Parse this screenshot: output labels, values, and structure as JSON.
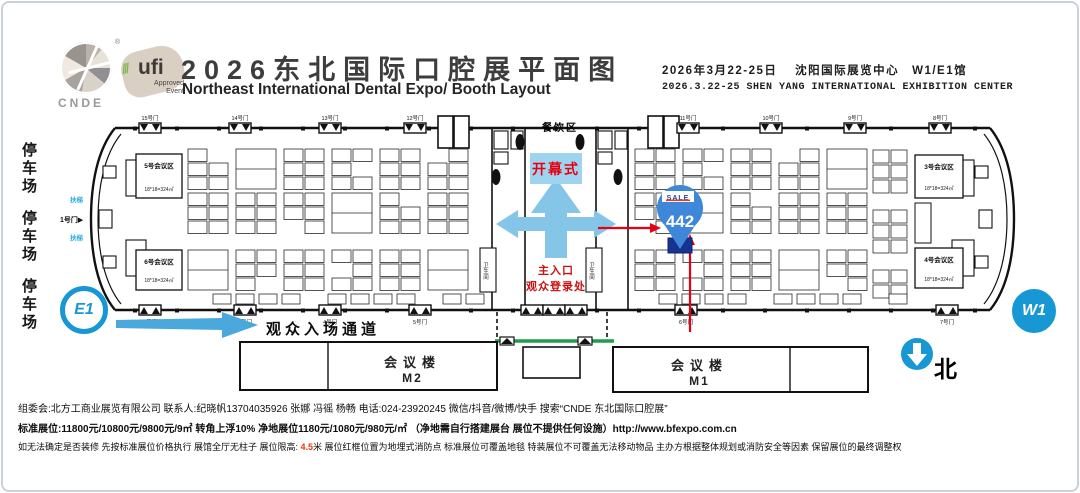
{
  "header": {
    "logo_cnde": "CNDE",
    "logo_ufi": "ufi",
    "logo_ufi_sub1": "Approved",
    "logo_ufi_sub2": "Event",
    "title_cn": "2026东北国际口腔展平面图",
    "title_en": "Northeast International Dental Expo/ Booth Layout",
    "date_cn": "2026年3月22-25日　 沈阳国际展览中心　W1/E1馆",
    "date_en": "2026.3.22-25  SHEN YANG INTERNATIONAL EXHIBITION CENTER"
  },
  "parking": {
    "p1": "停车场",
    "p2": "停车场",
    "p3": "停车场"
  },
  "hall": {
    "gate_e1": "E1",
    "gate_w1": "W1",
    "dining": "餐饮区",
    "opening": "开幕式",
    "entrance_line1": "主入口",
    "entrance_line2": "观众登录处",
    "meeting5": "5号会议区",
    "meeting5_size": "18*18=324㎡",
    "meeting6": "6号会议区",
    "meeting6_size": "18*18=324㎡",
    "meeting3": "3号会议区",
    "meeting3_size": "18*18=324㎡",
    "meeting4": "4号会议区",
    "meeting4_size": "18*18=324㎡",
    "restroom": "卫生间",
    "escalator_up": "扶梯",
    "escalator_down": "扶梯",
    "door1": "1号门",
    "doors_bottom": [
      "2号门",
      "3号门",
      "4号门",
      "5号门",
      "6号门",
      "7号门"
    ],
    "doors_top": [
      "15号门",
      "14号门",
      "13号门",
      "12号门",
      "11号门",
      "10号门",
      "9号门",
      "8号门"
    ],
    "marker": {
      "logo": "SALE",
      "booth": "442"
    }
  },
  "bottom": {
    "visitor_channel": "观众入场通道",
    "m2_name": "会议楼",
    "m2_code": "M2",
    "m1_name": "会议楼",
    "m1_code": "M1",
    "north": "北"
  },
  "footer": {
    "line1": "组委会:北方工商业展览有限公司 联系人:纪晓帆13704035926 张娜 冯徭 杨畅 电话:024-23920245  微信/抖音/微博/快手 搜索“CNDE 东北国际口腔展”",
    "line2": "标准展位:11800元/10800元/9800元/9㎡ 转角上浮10%  净地展位1180元/1080元/980元/㎡ （净地需自行搭建展台 展位不提供任何设施）http://www.bfexpo.com.cn",
    "line3_a": "如无法确定是否装修 先按标准展位价格执行 展馆全厅无柱子 展位限高: ",
    "line3_red": "4.5",
    "line3_b": "米  展位红框位置为地埋式消防点 标准展位可覆盖地毯 特装展位不可覆盖无法移动物品 主办方根据整体规划或消防安全等因素 保留展位的最终调整权"
  },
  "colors": {
    "accent_blue": "#1797d3",
    "light_blue": "#85c6e8",
    "red": "#e60012",
    "green": "#1f9d4d",
    "balloon": "#3f87d8"
  }
}
